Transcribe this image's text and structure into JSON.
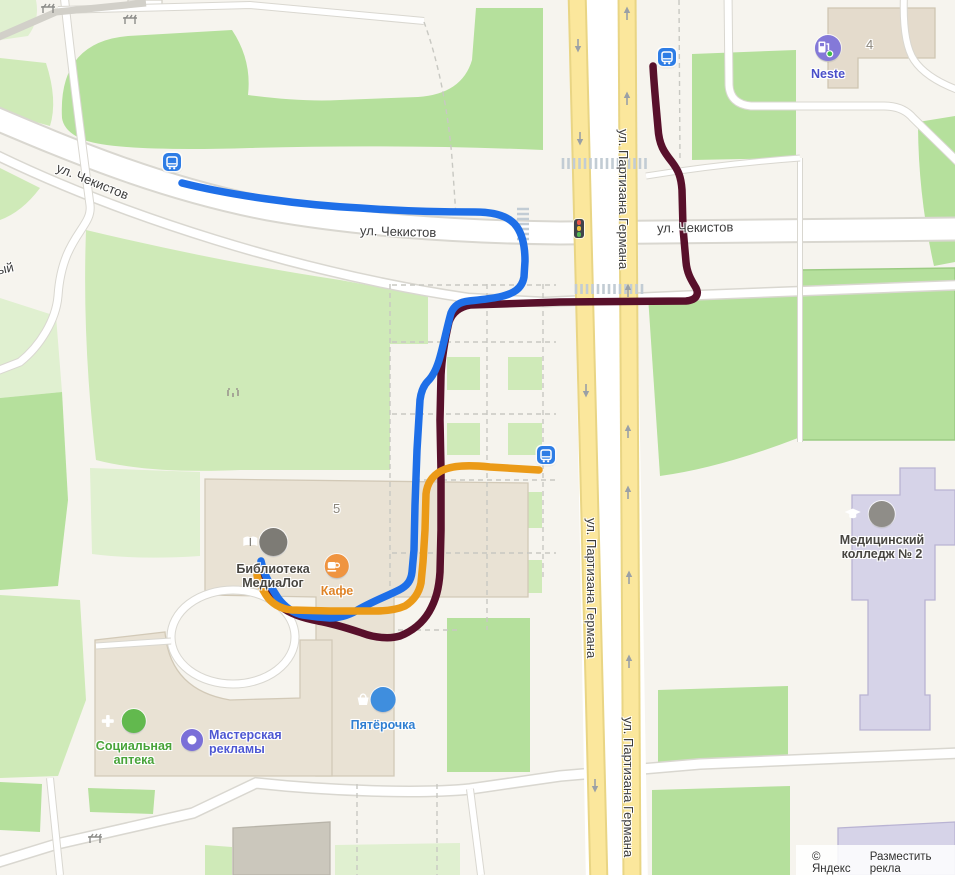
{
  "map": {
    "attribution": {
      "copyright": "© Яндекс",
      "place_ad": "Разместить рекла"
    },
    "streets": {
      "chekistov": "ул. Чекистов",
      "partizana_germana": "ул. Партизана Германа",
      "edge_fragment": "ый"
    },
    "building_numbers": {
      "library": "5",
      "neste": "4"
    },
    "pois": {
      "library": {
        "line1": "Библиотека",
        "line2": "МедиаЛог",
        "label_color": "#474540"
      },
      "cafe": {
        "label": "Кафе",
        "label_color": "#df8326"
      },
      "pyaterochka": {
        "label": "Пятёрочка",
        "label_color": "#2f7fd2"
      },
      "pharmacy": {
        "line1": "Социальная",
        "line2": "аптека",
        "label_color": "#48a339"
      },
      "ad_workshop": {
        "line1": "Мастерская",
        "line2": "рекламы",
        "label_color": "#4d57d2"
      },
      "med_college": {
        "line1": "Медицинский",
        "line2": "колледж № 2",
        "label_color": "#474540"
      },
      "neste": {
        "label": "Neste",
        "label_color": "#4a4fc9"
      }
    },
    "colors": {
      "route_blue": "#1e6fe8",
      "route_dark_red": "#58102b",
      "route_orange": "#eb9a17",
      "road_yellow": "#fbe79c",
      "park_green": "#b5e09c",
      "bus_stop_blue": "#2e7de5"
    },
    "routes": {
      "blue": {
        "color": "#1e6fe8",
        "path": "M182,183 C230,195 300,205 360,208 C400,211 440,212 475,212 C498,212 511,218 517,227 C523,236 525,248 525,261 L524,277 C522,289 513,294 499,297 C489,299 478,300 469,301 C459,302 454,306 451,313 C447,327 444,343 440,357 C437,368 433,376 428,381 C423,386 421,392 420,400 L417,450 L415,505 L414,550 L412,572 C411,581 407,586 399,590 C385,597 369,603 356,611 C347,616 339,618 330,618 L318,617 L303,615 C292,613 284,606 278,598 C272,589 266,577 263,569 L261,561"
      },
      "dark_red": {
        "color": "#58102b",
        "path": "M653,66 C654,85 656,105 658,128 C659,145 664,152 672,162 C678,170 681,176 682,190 L683,228 L686,262 C687,274 692,281 696,288 C699,294 697,300 686,301 L560,302 L470,305 C459,307 452,313 449,322 C446,335 442,355 441,375 L440,420 L441,470 L441,530 L440,572 C439,588 436,600 429,612 C423,622 413,631 400,636 C390,639 375,638 362,633 C350,629 335,624 318,621 C303,618 290,614 280,606 C272,598 265,587 261,577 L259,569"
      },
      "orange": {
        "color": "#eb9a17",
        "path": "M539,470 L490,467 C470,465 452,465 441,471 C432,476 427,484 426,494 L425,530 L423,562 L421,583 C419,593 413,601 405,606 C396,610 386,611 375,611 L330,611 L292,610 C280,609 271,603 266,595 C261,587 258,581 257,575"
      }
    }
  }
}
